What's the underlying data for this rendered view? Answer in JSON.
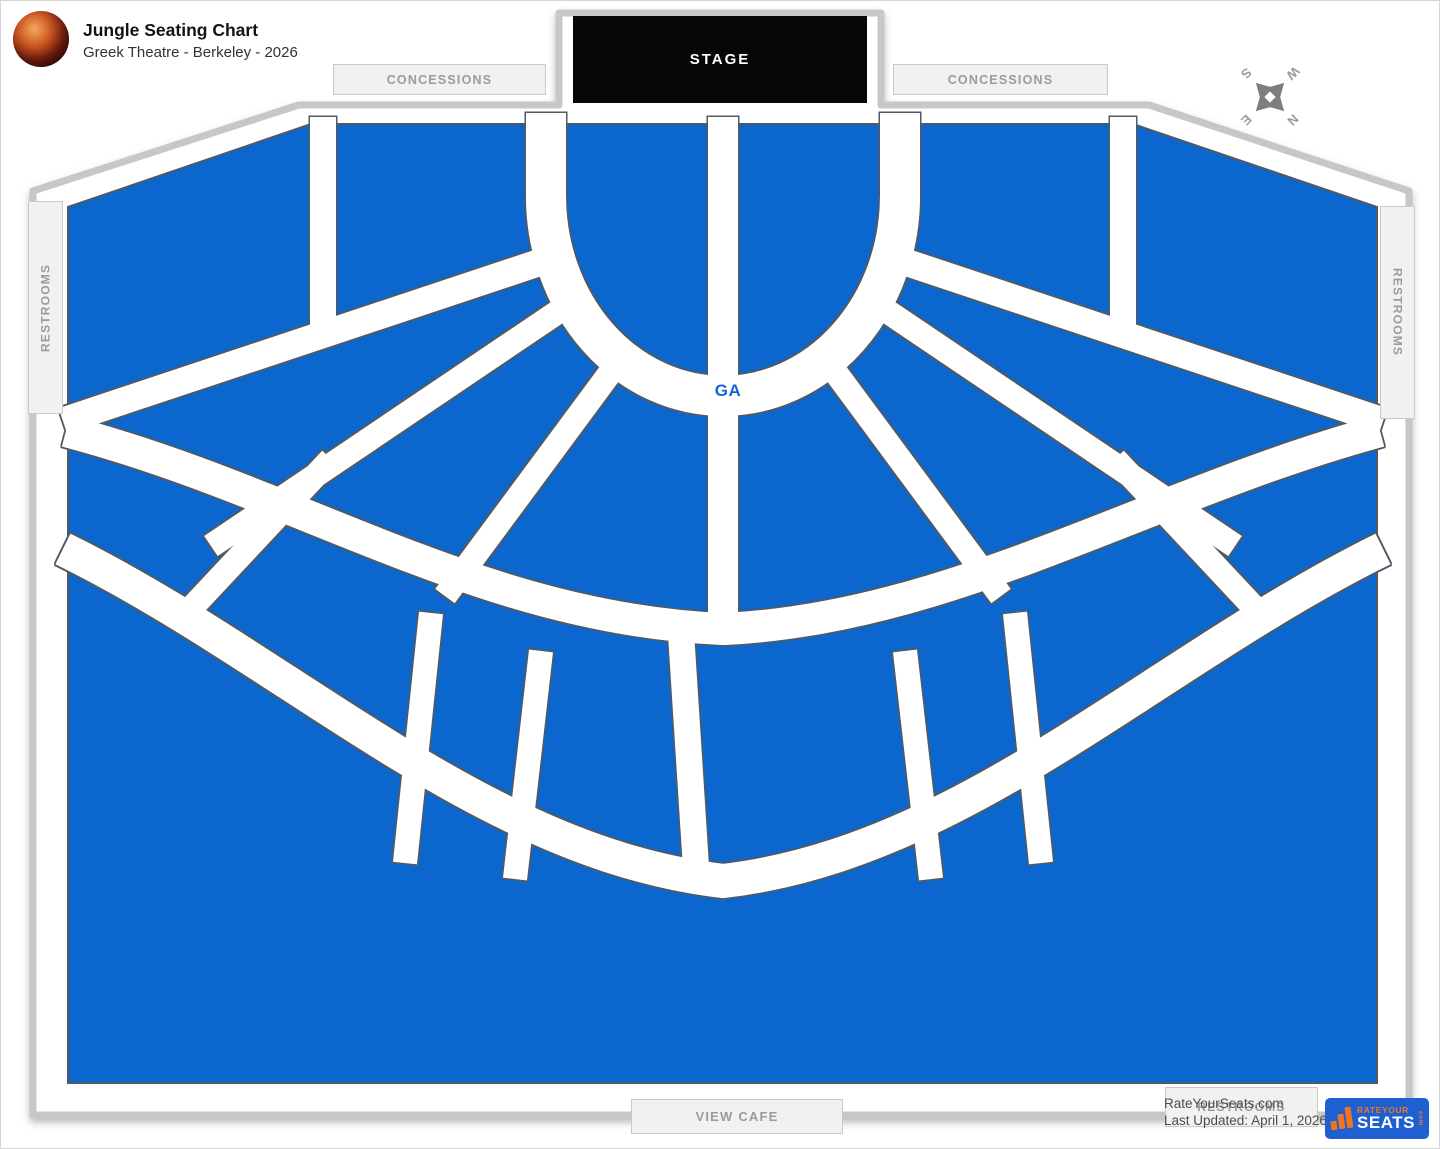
{
  "header": {
    "title": "Jungle Seating Chart",
    "subtitle": "Greek Theatre - Berkeley - 2026"
  },
  "map": {
    "stage_label": "STAGE",
    "ga_label": "GA",
    "concessions_left": "CONCESSIONS",
    "concessions_right": "CONCESSIONS",
    "restrooms_left": "RESTROOMS",
    "restrooms_right": "RESTROOMS",
    "restrooms_bottom": "RESTROOMS",
    "view_cafe": "VIEW CAFE",
    "compass": {
      "n": "N",
      "e": "E",
      "s": "S",
      "w": "W"
    }
  },
  "footer": {
    "credit_line1": "RateYourSeats.com",
    "credit_line2": "Last Updated: April 1, 2026",
    "logo": {
      "top": "RATEYOUR",
      "main": "SEATS",
      "suffix": "com"
    }
  },
  "theme": {
    "seating_blue": "#0b67ce",
    "logo_blue": "#1e60d2",
    "logo_orange": "#f1751f",
    "ga_text": "#1265d6"
  }
}
